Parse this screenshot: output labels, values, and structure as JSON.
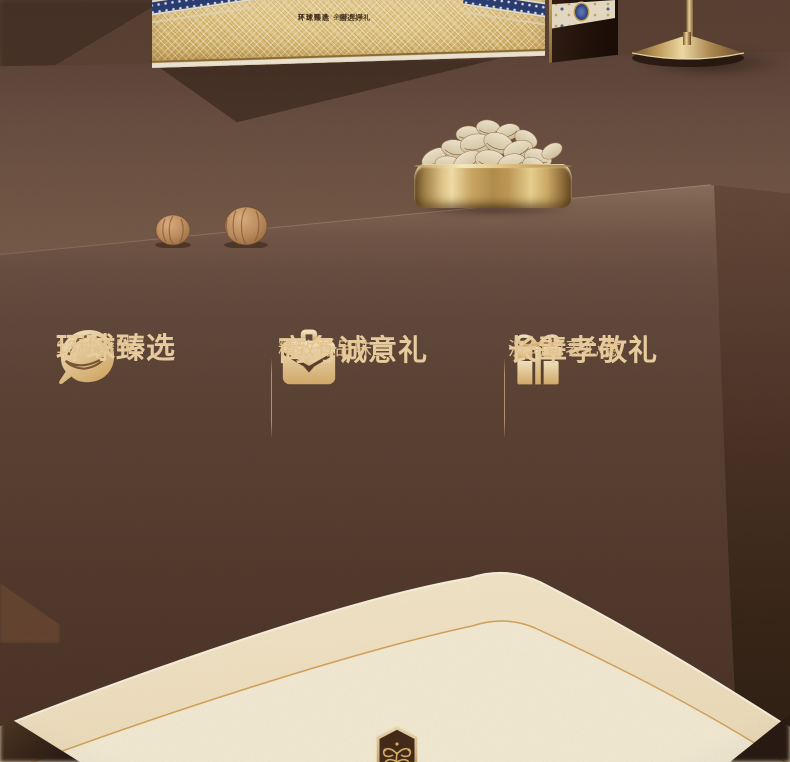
{
  "scene": {
    "label": "nut gift box promo section"
  },
  "features": [
    {
      "icon": "nut-icon",
      "title": "环球臻选",
      "subtitle": "13种美味"
    },
    {
      "icon": "briefcase-icon",
      "title": "商务诚意礼",
      "subtitle": "精致有品味"
    },
    {
      "icon": "gift-icon",
      "title": "长辈孝敬礼",
      "subtitle": "沉甸甸表心意"
    }
  ],
  "gift_box": {
    "print_line1": "环球甄选 全球风味",
    "print_line2": "环球臻选 · 甄选好礼"
  },
  "colors": {
    "accent_gold": "#f0d3a3",
    "panel_brown": "#62493c",
    "cream": "#f5e8cc",
    "navy_band": "#2c3e74",
    "metal_gold": "#e7c98d"
  }
}
